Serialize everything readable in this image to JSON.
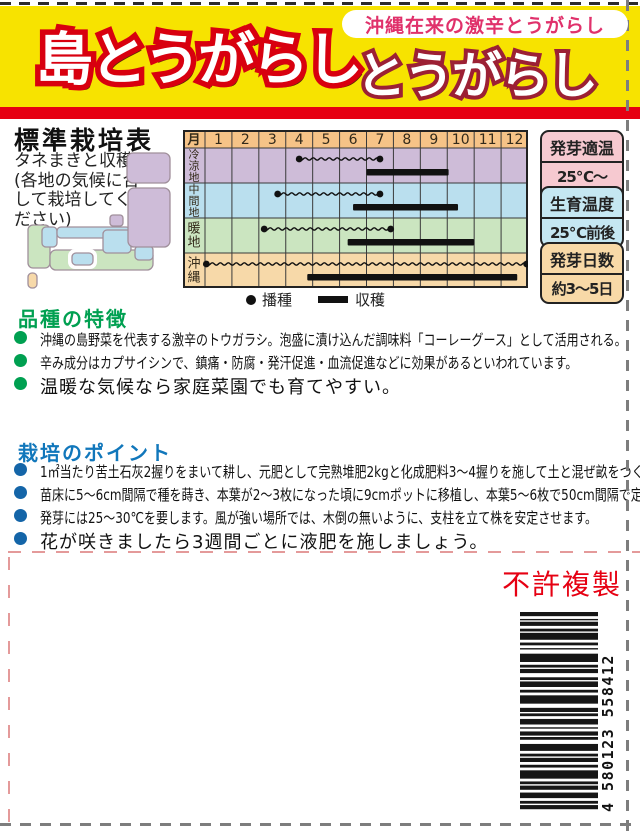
{
  "header": {
    "main_title": "島とうがらし",
    "tagline": "沖縄在来の激辛とうがらし",
    "sub_title": "とうがらし"
  },
  "colors": {
    "yellow_band": "#f7e300",
    "red_stripe": "#e60012",
    "title_outline_red": "#d8000f",
    "subtitle_outline_maroon": "#9c2034",
    "tagline_pink": "#e0316b",
    "feature_green": "#00a051",
    "point_blue": "#1177bb",
    "no_copy_red": "#e60012"
  },
  "cultivation": {
    "title": "標準栽培表",
    "note_lines": [
      "タネまきと収穫",
      "(各地の気候に合",
      "して栽培してく",
      "ださい)"
    ],
    "table": {
      "month_header": "月",
      "months": [
        "1",
        "2",
        "3",
        "4",
        "5",
        "6",
        "7",
        "8",
        "9",
        "10",
        "11",
        "12"
      ],
      "rows": [
        {
          "region": "冷涼地",
          "bg": "#cebcd8",
          "sow": [
            4.5,
            7.5
          ],
          "harvest": [
            7.0,
            10.05
          ]
        },
        {
          "region": "中間地",
          "bg": "#badfee",
          "sow": [
            3.7,
            7.5
          ],
          "harvest": [
            6.5,
            10.4
          ]
        },
        {
          "region": "暖地",
          "bg": "#cbe5c0",
          "sow": [
            3.2,
            7.9
          ],
          "harvest": [
            6.3,
            11.0
          ]
        },
        {
          "region": "沖縄",
          "bg": "#f7d9a9",
          "sow": [
            1.05,
            12.95
          ],
          "harvest": [
            4.8,
            12.6
          ]
        }
      ],
      "header_bg": "#f6c387"
    },
    "legend": {
      "sow_label": "播種",
      "harvest_label": "収穫"
    },
    "info_boxes": [
      {
        "label": "発芽適温",
        "value": "25℃〜30℃",
        "bg": "#f6c9d0"
      },
      {
        "label": "生育温度",
        "value": "25℃前後",
        "bg": "#c5e7f2"
      },
      {
        "label": "発芽日数",
        "value": "約3〜5日",
        "bg": "#f8d9a7"
      }
    ]
  },
  "features": {
    "title": "品種の特徴",
    "items": [
      "沖縄の島野菜を代表する激辛のトウガラシ。泡盛に漬け込んだ調味料「コーレーグース」として活用される。",
      "辛み成分はカプサイシンで、鎮痛・防腐・発汗促進・血流促進などに効果があるといわれています。",
      "温暖な気候なら家庭菜園でも育てやすい。"
    ]
  },
  "points": {
    "title": "栽培のポイント",
    "items": [
      "1㎡当たり苦土石灰2握りをまいて耕し、元肥として完熟堆肥2kgと化成肥料3〜4握りを施して土と混ぜ畝をつくります。",
      "苗床に5〜6cm間隔で種を蒔き、本葉が2〜3枚になった頃に9cmポットに移植し、本葉5〜6枚で50cm間隔で定植します。",
      "発芽には25〜30℃を要します。風が強い場所では、木倒の無いように、支柱を立て株を安定させます。",
      "花が咲きましたら3週間ごとに液肥を施しましょう。"
    ]
  },
  "footer": {
    "no_copy": "不許複製",
    "barcode_number": "4 580123 558412"
  }
}
